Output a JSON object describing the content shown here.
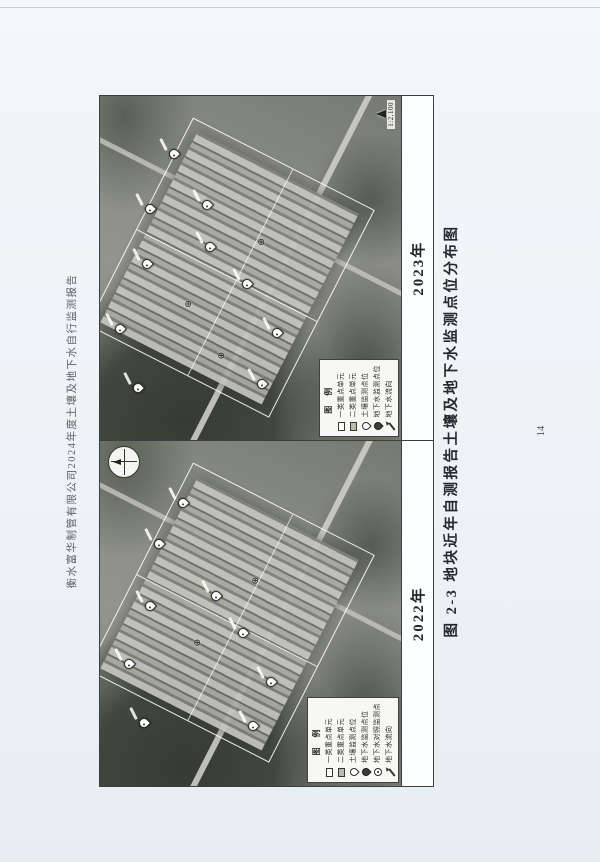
{
  "page": {
    "header": "衡水富华制管有限公司2024年度土壤及地下水自行监测报告",
    "caption": "图 2-3  地块近年自测报告土壤及地下水监测点位分布图",
    "page_number": "14"
  },
  "panels": [
    {
      "year_label": "2022年",
      "legend": {
        "title": "图 例",
        "items": [
          {
            "symbol": "rect-outline",
            "label": "一类重点单元"
          },
          {
            "symbol": "rect-fill",
            "label": "二类重点单元"
          },
          {
            "symbol": "pin-light",
            "label": "土壤监测点位"
          },
          {
            "symbol": "pin-dark",
            "label": "地下水监测点位"
          },
          {
            "symbol": "pin-dot",
            "label": "地下水对照监测点"
          },
          {
            "symbol": "arrow",
            "label": "地下水流向"
          }
        ]
      },
      "markers": [
        {
          "type": "pin",
          "x": 18,
          "y": 16
        },
        {
          "type": "pin",
          "x": 35,
          "y": 11
        },
        {
          "type": "pin",
          "x": 52,
          "y": 18
        },
        {
          "type": "pin",
          "x": 70,
          "y": 21
        },
        {
          "type": "pin",
          "x": 82,
          "y": 29
        },
        {
          "type": "pin",
          "x": 55,
          "y": 40
        },
        {
          "type": "pin",
          "x": 44,
          "y": 49
        },
        {
          "type": "pin",
          "x": 30,
          "y": 58
        },
        {
          "type": "pin",
          "x": 17,
          "y": 52
        },
        {
          "type": "cross",
          "x": 42,
          "y": 33
        },
        {
          "type": "cross",
          "x": 60,
          "y": 52
        }
      ]
    },
    {
      "year_label": "2023年",
      "legend": {
        "title": "图 例",
        "items": [
          {
            "symbol": "rect-outline",
            "label": "一类重点单元"
          },
          {
            "symbol": "rect-fill",
            "label": "二类重点单元"
          },
          {
            "symbol": "pin-light",
            "label": "土壤监测点位"
          },
          {
            "symbol": "pin-dark",
            "label": "地下水监测点位"
          },
          {
            "symbol": "arrow",
            "label": "地下水流向"
          }
        ]
      },
      "scale_text": "1:2,100",
      "markers": [
        {
          "type": "pin",
          "x": 15,
          "y": 14
        },
        {
          "type": "pin",
          "x": 32,
          "y": 8
        },
        {
          "type": "pin",
          "x": 51,
          "y": 17
        },
        {
          "type": "pin",
          "x": 67,
          "y": 18
        },
        {
          "type": "pin",
          "x": 83,
          "y": 26
        },
        {
          "type": "pin",
          "x": 56,
          "y": 38
        },
        {
          "type": "pin",
          "x": 68,
          "y": 37
        },
        {
          "type": "pin",
          "x": 45,
          "y": 50
        },
        {
          "type": "pin",
          "x": 31,
          "y": 60
        },
        {
          "type": "pin",
          "x": 16,
          "y": 55
        },
        {
          "type": "cross",
          "x": 40,
          "y": 30
        },
        {
          "type": "cross",
          "x": 58,
          "y": 54
        },
        {
          "type": "cross",
          "x": 25,
          "y": 41
        }
      ]
    }
  ]
}
